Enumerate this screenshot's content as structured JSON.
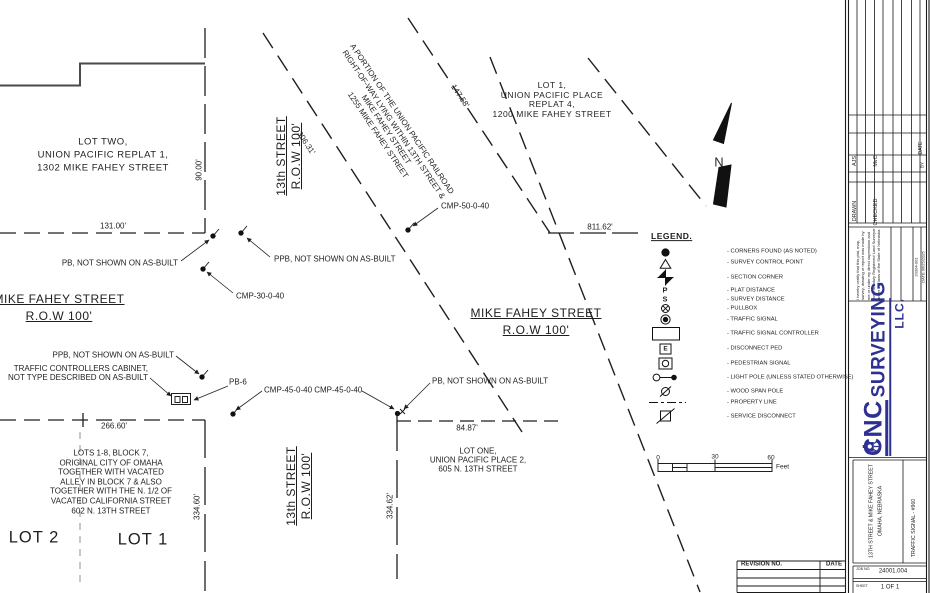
{
  "drawing": {
    "parcels": {
      "lot_two": "LOT TWO,\nUNION PACIFIC REPLAT 1,\n1302 MIKE FAHEY STREET",
      "lot_one_replat4": "LOT 1,\nUNION PACIFIC PLACE\nREPLAT 4,\n1200 MIKE FAHEY STREET",
      "railroad_parcel": "A PORTION OF THE UNION PACIFIC RAILROAD\nRIGHT-OF-WAY LYING WITHIN 13TH STREET &\nMIKE FAHEY STREET\n1255 MIKE FAHEY STREET",
      "lots_block7": "LOTS 1-8, BLOCK 7,\nORIGINAL CITY OF OMAHA\nTOGETHER WITH VACATED\nALLEY IN BLOCK 7 & ALSO\nTOGETHER WITH THE N. 1/2 OF\nVACATED CALIFORNIA STREET\n602 N. 13TH STREET",
      "lot_one_place2": "LOT ONE,\nUNION PACIFIC PLACE 2,\n605 N. 13TH STREET",
      "lot_1": "LOT 1",
      "lot_2": "LOT 2"
    },
    "streets": {
      "thirteenth_north": "13th STREET\nR.O.W 100'",
      "thirteenth_south": "13th STREET\nR.O.W 100'",
      "mike_fahey_west": "MIKE FAHEY STREET\nR.O.W 100'",
      "mike_fahey_east": "MIKE FAHEY STREET\nR.O.W 100'"
    },
    "dimensions": {
      "d131": "131.00'",
      "d90": "90.00'",
      "d306": "306.31'",
      "d147": "147.58'",
      "d811": "811.62'",
      "d266": "266.60'",
      "d84": "84.87'",
      "d334_60": "334.60'",
      "d334_62": "334.62'"
    },
    "callouts": {
      "pb_north": "PB, NOT SHOWN ON AS-BUILT",
      "ppb_north": "PPB, NOT SHOWN ON AS-BUILT",
      "cmp_30": "CMP-30-0-40",
      "cmp_50": "CMP-50-0-40",
      "ppb_south": "PPB, NOT SHOWN ON AS-BUILT",
      "cabinet": "TRAFFIC CONTROLLERS CABINET,\nNOT TYPE DESCRIBED ON AS-BUILT",
      "pb6": "PB-6",
      "cmp_45": "CMP-45-0-40 CMP-45-0-40",
      "pb_south": "PB, NOT SHOWN ON AS-BUILT"
    },
    "north_label": "N",
    "scale_bar": {
      "tick0": "0",
      "tick30": "30",
      "tick60": "60",
      "unit": "Feet"
    }
  },
  "legend": {
    "title": "LEGEND.",
    "items": [
      {
        "symbol_name": "filled-circle-icon",
        "label": "- CORNERS FOUND (AS NOTED)"
      },
      {
        "symbol_name": "triangle-icon",
        "label": "- SURVEY CONTROL POINT"
      },
      {
        "symbol_name": "section-corner-icon",
        "label": "- SECTION CORNER"
      },
      {
        "symbol_name": "letter-p-icon",
        "symbol": "P",
        "label": "- PLAT DISTANCE"
      },
      {
        "symbol_name": "letter-s-icon",
        "symbol": "S",
        "label": "- SURVEY DISTANCE"
      },
      {
        "symbol_name": "circle-x-icon",
        "label": "- PULLBOX"
      },
      {
        "symbol_name": "circle-dot-icon",
        "label": "- TRAFFIC SIGNAL"
      },
      {
        "symbol_name": "rectangle-icon",
        "label": "- TRAFFIC SIGNAL CONTROLLER"
      },
      {
        "symbol_name": "boxed-e-icon",
        "symbol": "E",
        "label": "- DISCONNECT PED"
      },
      {
        "symbol_name": "boxed-circle-icon",
        "label": "- PEDESTRIAN SIGNAL"
      },
      {
        "symbol_name": "light-pole-icon",
        "label": "- LIGHT POLE (UNLESS STATED OTHERWISE)"
      },
      {
        "symbol_name": "circle-slash-icon",
        "label": "- WOOD SPAN POLE"
      },
      {
        "symbol_name": "dashed-line-icon",
        "label": "- PROPERTY LINE"
      },
      {
        "symbol_name": "square-diagonal-icon",
        "label": "- SERVICE DISCONNECT"
      }
    ]
  },
  "title_block": {
    "drawn_label": "DRAWN",
    "drawn_by": "AJS",
    "checked_label": "CHECKED",
    "checked_by": "MvC",
    "date_label": "DATE",
    "by_label": "BY",
    "certification": "I hereby certify that this plat, map, survey, drawing or report was made by me or under my direct supervision and that I am duly Registered Land Surveyor under the laws of the State of Nebraska.",
    "cert_number": "20304-001",
    "cert_date": "DATE 06/25/2025",
    "company": {
      "cnc": "CNC",
      "surveying": "SURVEYING",
      "llc": "LLC.",
      "brand_color": "#2e3192"
    },
    "project": "13TH STREET & MIKE FAHEY STREET\nOMAHA, NEBRASKA",
    "sheet_title": "TRAFFIC SIGNAL - #960",
    "job_label": "JOB NO.",
    "job_number": "24001.004",
    "sheet_label": "SHEET",
    "sheet_number": "1 OF 1"
  },
  "revision_table": {
    "revision_label": "REVISION NO.",
    "date_label": "DATE"
  }
}
